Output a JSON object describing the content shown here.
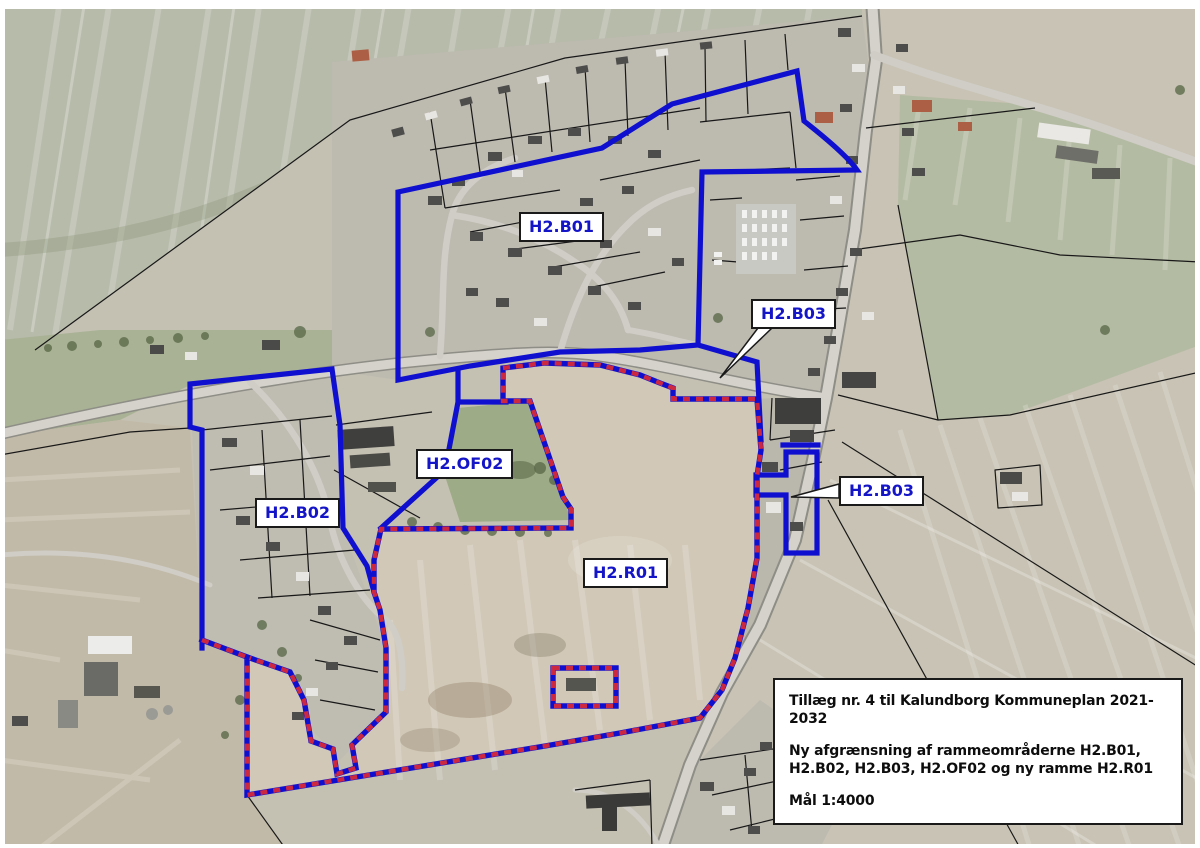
{
  "map": {
    "title_note": "aerial zoning map",
    "labels": {
      "b01": "H2.B01",
      "b03_top": "H2.B03",
      "of02": "H2.OF02",
      "b02": "H2.B02",
      "r01": "H2.R01",
      "b03_right": "H2.B03"
    },
    "info_box": {
      "line1": "Tillæg nr. 4 til Kalundborg Kommuneplan 2021-2032",
      "line2": "Ny afgrænsning af rammeområderne H2.B01,",
      "line3": " H2.B02, H2.B03, H2.OF02 og ny ramme H2.R01",
      "line4": "Mål 1:4000"
    },
    "colors": {
      "boundary_blue": "#0f0fd0",
      "dash_red": "#cc2840",
      "label_text_blue": "#1515c8",
      "label_border": "#1a1a1a"
    }
  }
}
